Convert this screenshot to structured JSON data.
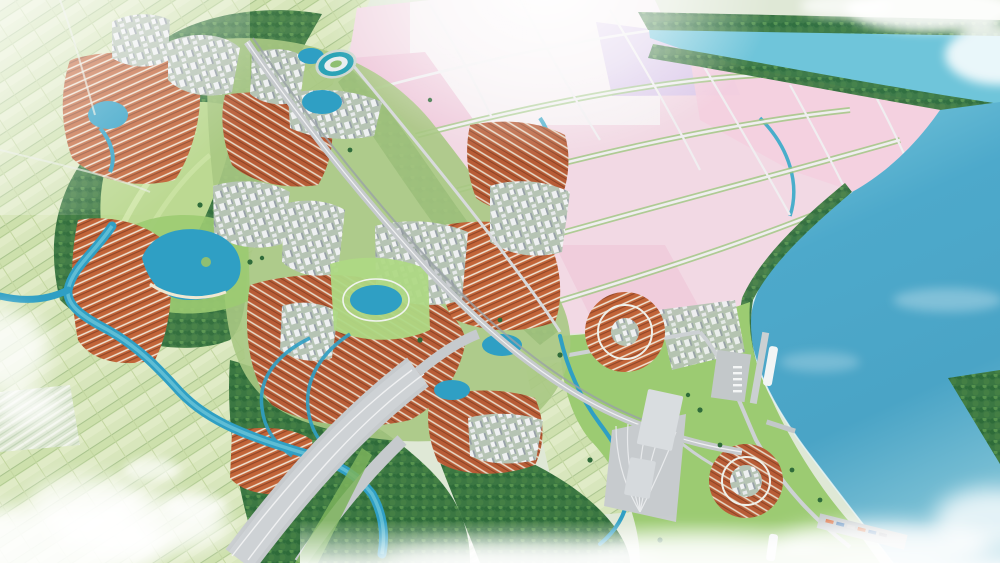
{
  "scene": {
    "type": "aerial-3d-masterplan-render",
    "alt": "Aerial 3D rendering of a planned coastal township: a grid of pale pink and lavender industrial plots beside a teal river at top right, a wide blue bay with port piers, ships and a wharf on the right, clusters of orange-roofed row houses and white mid-rise buildings along a diagonal avenue, lakes, parks, a stadium, a winding river, pale green farmland and forest on the left, a wide highway running to the bottom edge, and soft white clouds drifting over the corners."
  },
  "palette": {
    "haze_green": "#dfe8d6",
    "farm_light": "#d8e6bc",
    "farm_mid": "#c6d9a6",
    "hedge_green": "#9dba86",
    "forest_dark": "#35703e",
    "forest_mid": "#4a8a4f",
    "forest_light": "#69a45f",
    "grass_park": "#9ccb72",
    "grass_bright": "#aed884",
    "golf_green": "#bcd992",
    "water_river": "#6fc5da",
    "water_deep": "#479fc6",
    "water_lake": "#2f9fc4",
    "pink_plot": "#f2d9e4",
    "pink_strong": "#eec6d9",
    "lavender_plot": "#d9c8ea",
    "plot_white": "#f7f2f5",
    "road_gray": "#c6cacd",
    "road_light": "#ced2d5",
    "road_white": "#eff0f1",
    "median_green": "#7cb35c",
    "roof_orange": "#bf6138",
    "roof_stripe": "#ead",
    "bldg_white": "#eef0f1",
    "bldg_shadow": "#97a0a8",
    "bldg_gray": "#d9dde0",
    "stadium_ring": "#2ba3b6",
    "cloud_white": "#ffffff"
  }
}
